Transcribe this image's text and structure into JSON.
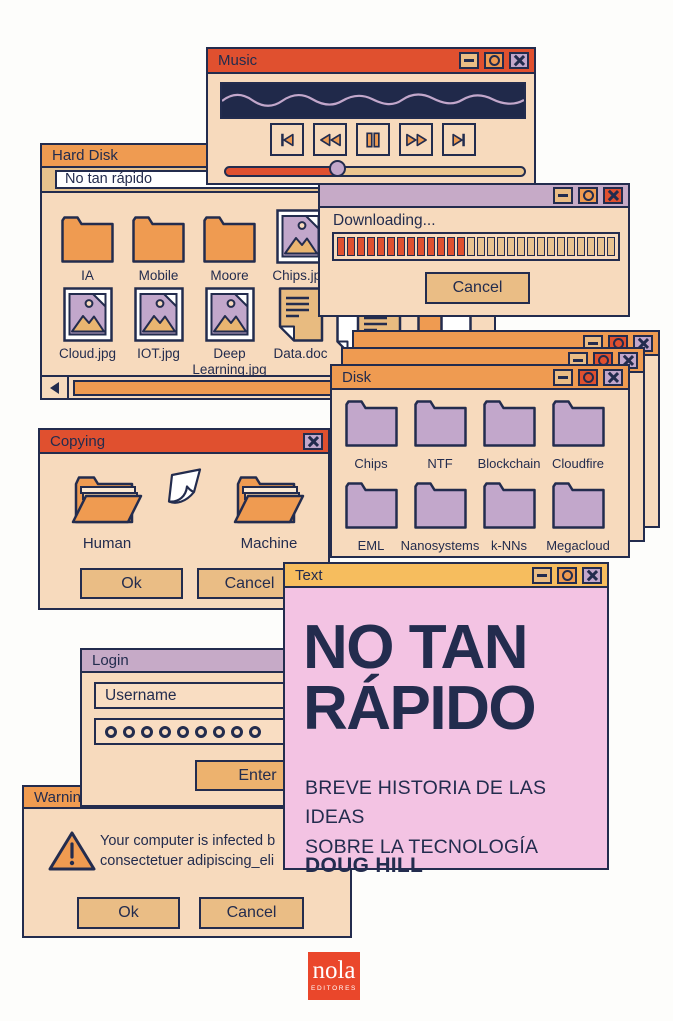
{
  "palette": {
    "outline": "#232c4e",
    "red": "#e0502f",
    "orange": "#ef9b51",
    "tan": "#eabd85",
    "cream": "#f7dabd",
    "lavender": "#c6aac7",
    "folder_purple": "#c2a7cb",
    "yellow": "#f6bd5e",
    "pink": "#f3c3e3"
  },
  "windows": {
    "music": {
      "title": "Music",
      "titlebar_buttons": [
        {
          "type": "minimize",
          "bg": "#eabd85"
        },
        {
          "type": "maximize",
          "bg": "#ef9b51"
        },
        {
          "type": "close",
          "bg": "#c2a7cb"
        }
      ],
      "transport": [
        "skip-start",
        "rewind",
        "pause",
        "fast-forward",
        "skip-end"
      ],
      "progress_percent": 38
    },
    "hard_disk": {
      "title": "Hard Disk",
      "address": "No tan rápido",
      "row1": [
        {
          "label": "IA",
          "type": "folder"
        },
        {
          "label": "Mobile",
          "type": "folder"
        },
        {
          "label": "Moore",
          "type": "folder"
        },
        {
          "label": "Chips.jpg",
          "type": "image"
        }
      ],
      "row2": [
        {
          "label": "Cloud.jpg",
          "type": "image"
        },
        {
          "label": "IOT.jpg",
          "type": "image"
        },
        {
          "label": "Deep Learning.jpg",
          "type": "image"
        },
        {
          "label": "Data.doc",
          "type": "doc"
        }
      ],
      "partial_file_label": "w"
    },
    "downloading": {
      "label": "Downloading...",
      "titlebar_buttons": [
        {
          "type": "minimize",
          "bg": "#eabd85"
        },
        {
          "type": "maximize",
          "bg": "#ef9b51"
        },
        {
          "type": "close",
          "bg": "#e0502f"
        }
      ],
      "progress": {
        "total": 28,
        "filled": 13
      },
      "cancel_label": "Cancel"
    },
    "disk": {
      "title": "Disk",
      "titlebar_buttons": [
        {
          "type": "minimize",
          "bg": "#eabd85"
        },
        {
          "type": "maximize",
          "bg": "#e0502f"
        },
        {
          "type": "close",
          "bg": "#c2a7cb"
        }
      ],
      "folders": [
        "Chips",
        "NTF",
        "Blockchain",
        "Cloudfire",
        "EML",
        "Nanosystems",
        "k-NNs",
        "Megacloud"
      ]
    },
    "copying": {
      "title": "Copying",
      "close_buttons": [
        {
          "type": "close",
          "bg": "#c2a7cb"
        }
      ],
      "source_label": "Human",
      "target_label": "Machine",
      "ok_label": "Ok",
      "cancel_label": "Cancel"
    },
    "login": {
      "title": "Login",
      "username_value": "Username",
      "password_dots": 9,
      "enter_label": "Enter"
    },
    "warning": {
      "title": "Warning",
      "message_line1": "Your computer is infected b",
      "message_line2": "consectetuer adipiscing_eli",
      "ok_label": "Ok",
      "cancel_label": "Cancel"
    },
    "text": {
      "title": "Text",
      "titlebar_buttons": [
        {
          "type": "minimize",
          "bg": "#eabd85"
        },
        {
          "type": "maximize",
          "bg": "#ef9b51"
        },
        {
          "type": "close",
          "bg": "#c2a7cb"
        }
      ],
      "heading_line1": "NO TAN",
      "heading_line2": "RÁPIDO",
      "subtitle_line1": "BREVE HISTORIA DE LAS IDEAS",
      "subtitle_line2": "SOBRE LA TECNOLOGÍA",
      "author": "DOUG HILL"
    }
  },
  "publisher": {
    "name": "nola",
    "subtitle": "EDITORES"
  }
}
